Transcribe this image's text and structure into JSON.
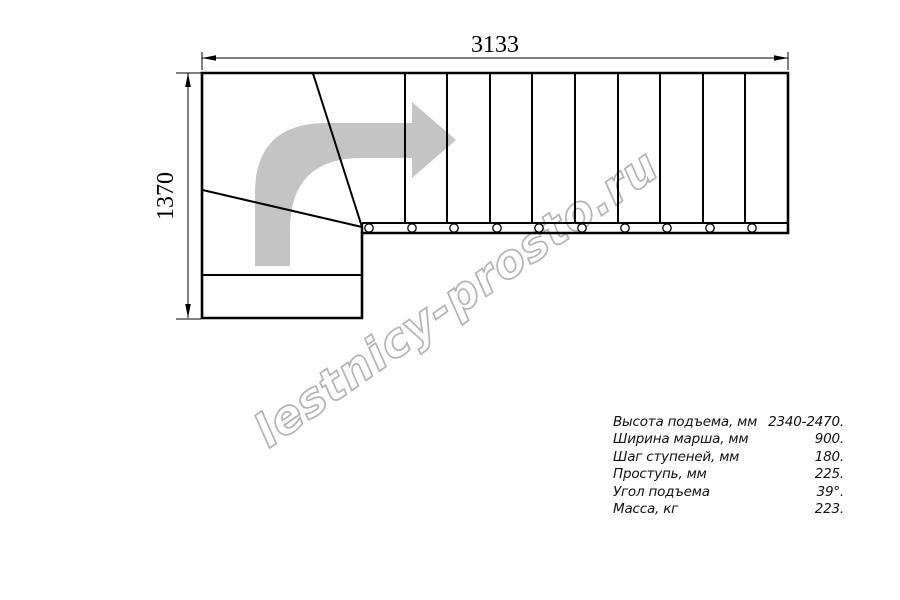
{
  "page": {
    "title": "Staircase plan drawing"
  },
  "watermark": {
    "text": "lestnicy-prosto.ru",
    "stroke_color": "#b3b3b3"
  },
  "colors": {
    "line": "#000000",
    "direction_arrow": "#c4c4c4",
    "background": "#ffffff"
  },
  "dimensions": {
    "width_label": "3133",
    "height_label": "1370"
  },
  "plan": {
    "straight_steps": 10,
    "mount_circles": 10
  },
  "specs": {
    "rows": [
      {
        "label": "Высота подъема, мм",
        "value": "2340-2470."
      },
      {
        "label": "Ширина марша, мм",
        "value": "900."
      },
      {
        "label": "Шаг ступеней, мм",
        "value": "180."
      },
      {
        "label": "Проступь, мм",
        "value": "225."
      },
      {
        "label": "Угол подъема",
        "value": "39°."
      },
      {
        "label": "Масса, кг",
        "value": "223."
      }
    ]
  }
}
